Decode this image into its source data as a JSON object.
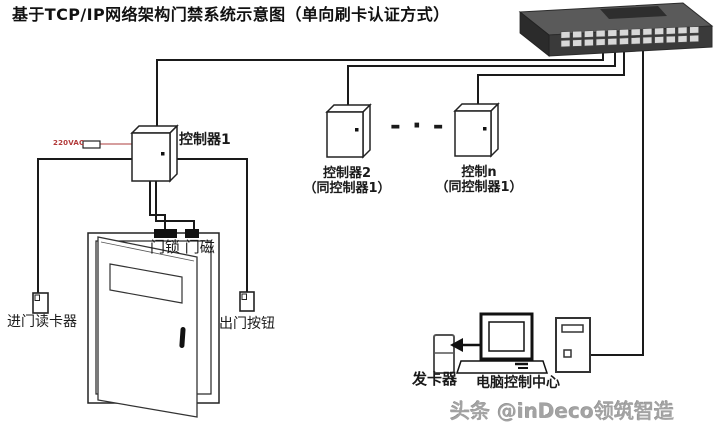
{
  "title": "基于TCP/IP网络架构门禁系统示意图（单向刷卡认证方式）",
  "diagram": {
    "power_label": "220VAC",
    "controller1": {
      "label": "控制器1"
    },
    "controller2": {
      "line1": "控制器2",
      "line2": "（同控制器1）"
    },
    "controller_n": {
      "line1": "控制n",
      "line2": "（同控制器1）"
    },
    "more_indicator": "- · -",
    "door": {
      "lock_magnet_label": "门锁 门磁"
    },
    "entry_reader_label": "进门读卡器",
    "exit_button_label": "出门按钮",
    "card_issuer_label": "发卡器",
    "control_center_label": "电脑控制中心"
  },
  "watermark": "头条 @inDeco领筑智造",
  "colors": {
    "wire": "#1a1a1a",
    "power_wire": "#c97f7f",
    "power_text": "#b23a3a",
    "switch_body": "#3a3a3a",
    "watermark": "#a3a3a3",
    "background": "#ffffff"
  }
}
